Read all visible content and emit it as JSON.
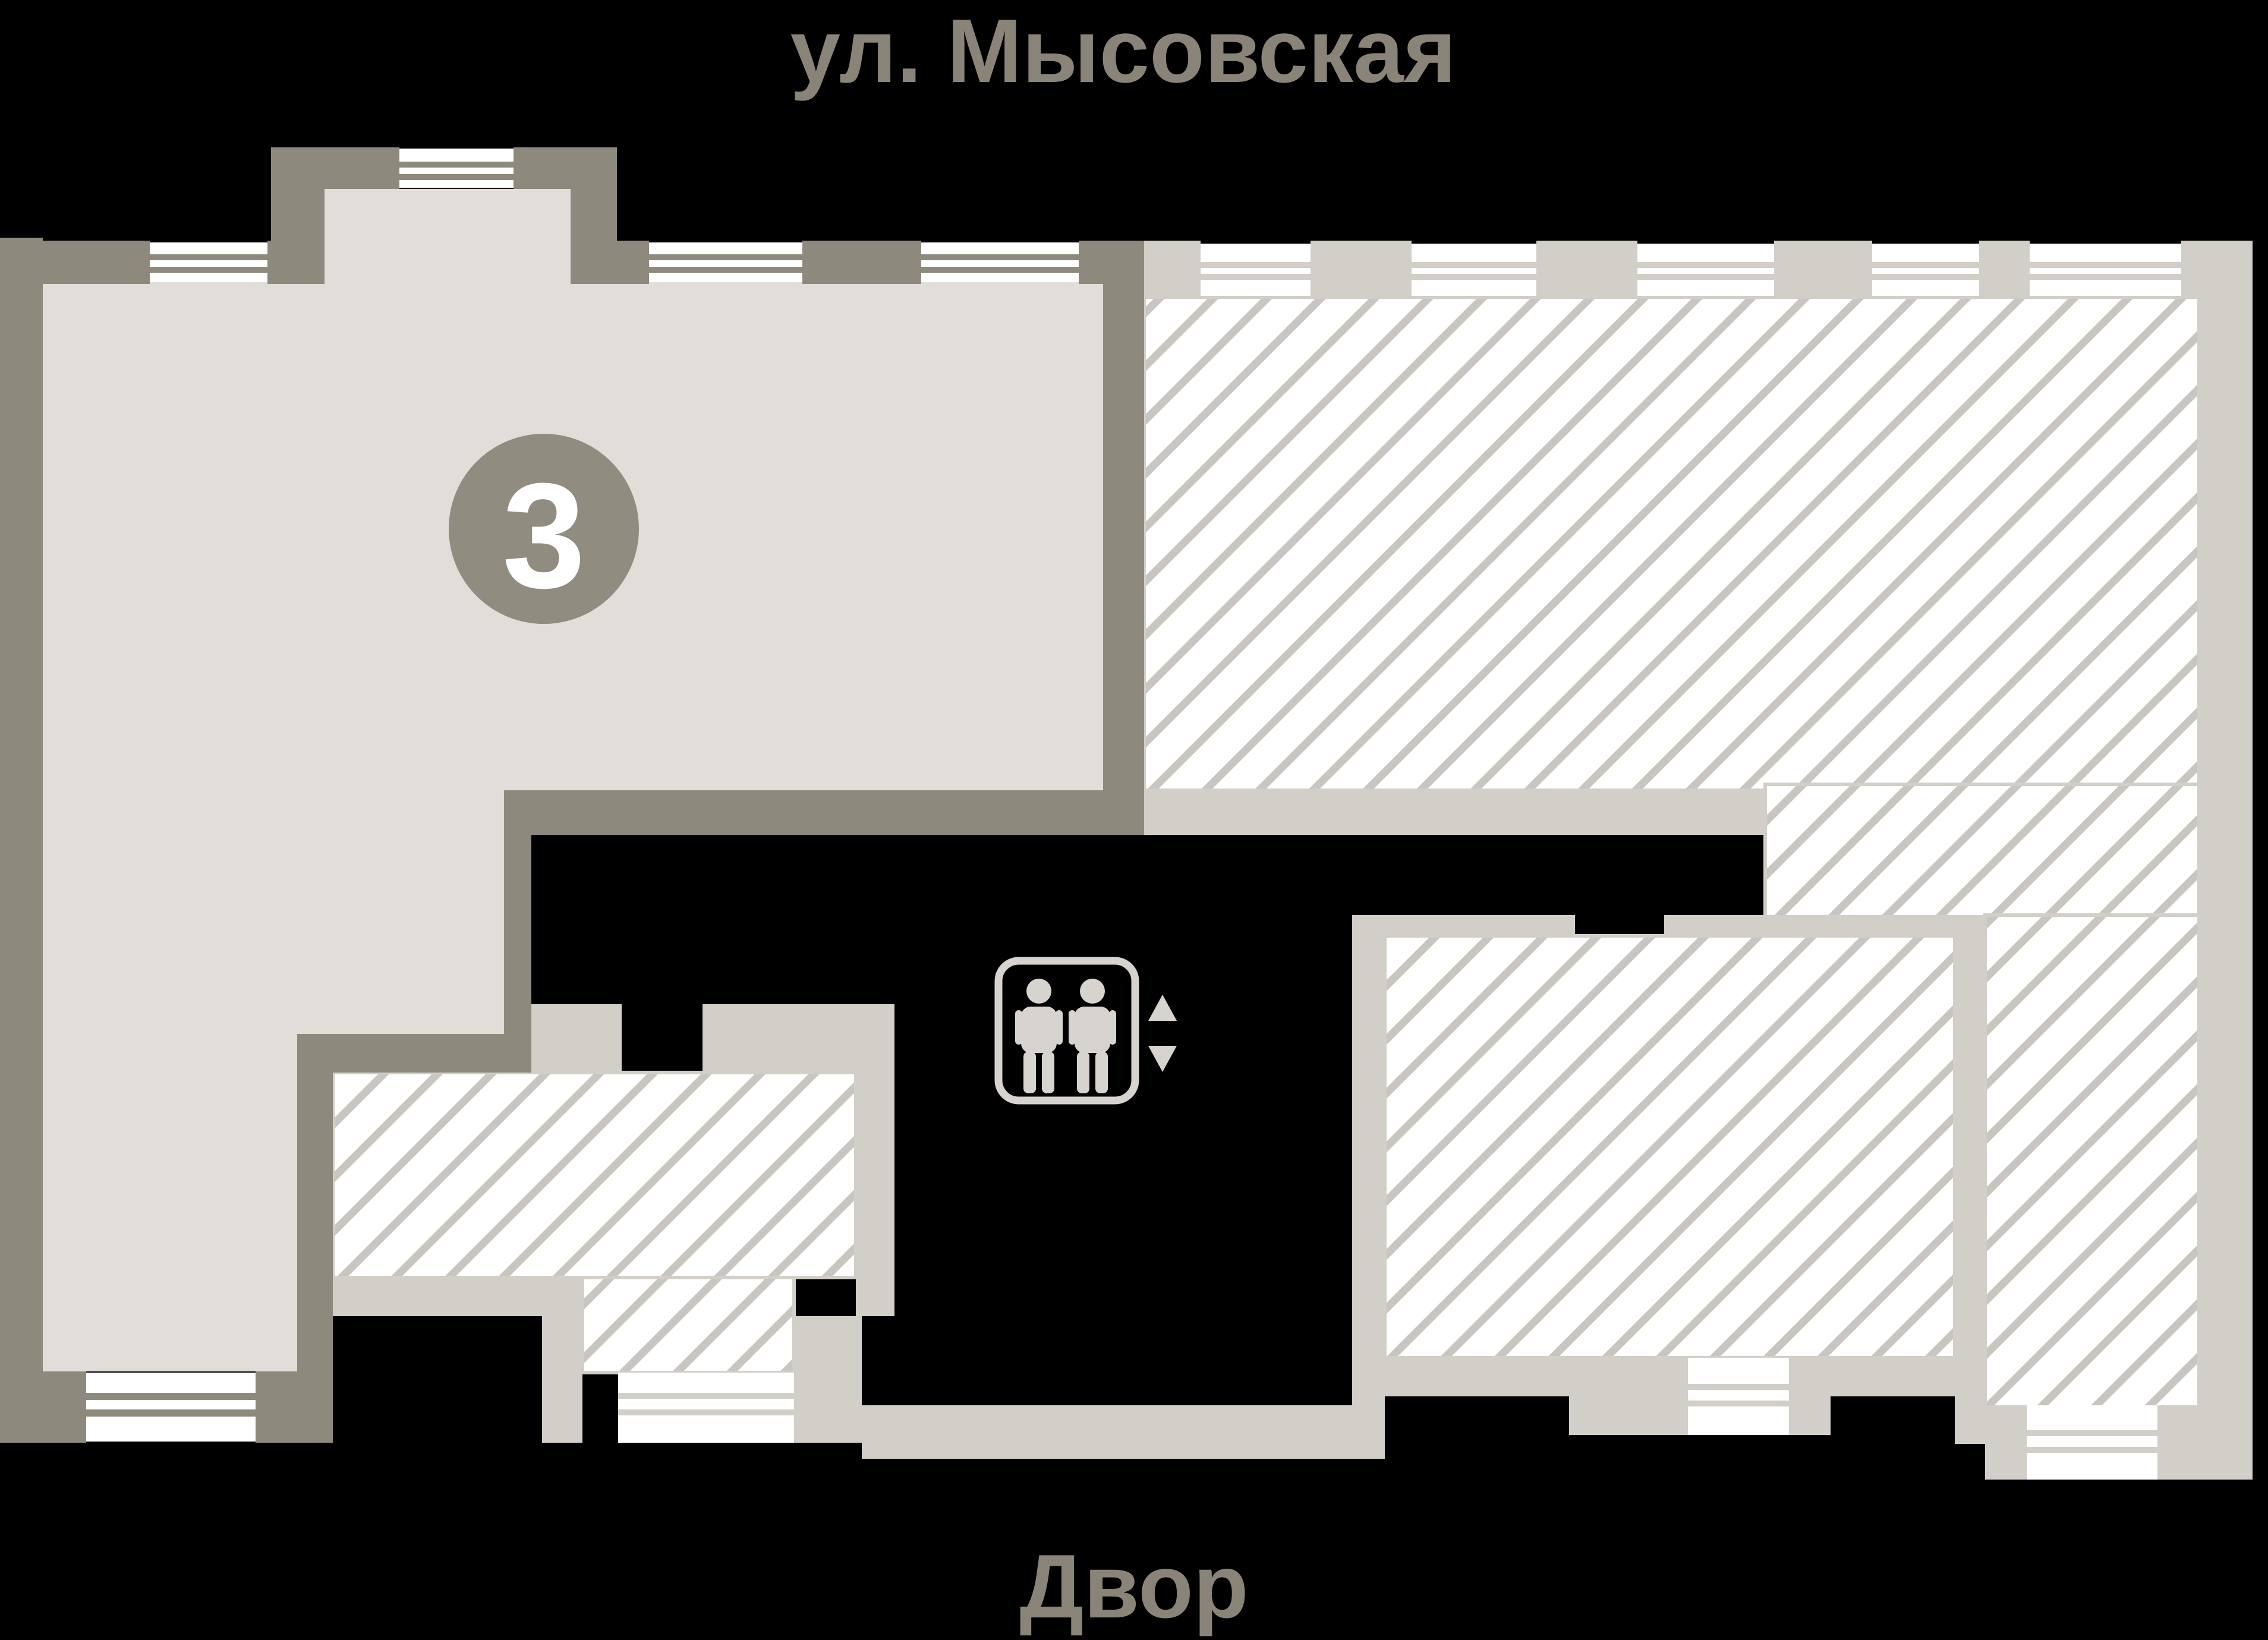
{
  "title": {
    "street": "ул. Мысовская",
    "courtyard": "Двор"
  },
  "apartment": {
    "number": "3"
  },
  "icons": {
    "elevator": "elevator-people-icon",
    "up": "triangle-up-icon",
    "down": "triangle-down-icon"
  },
  "colors": {
    "background": "#000000",
    "label_text": "#8a8478",
    "apartment_fill": "#e1ded9",
    "apartment_wall": "#8d897d",
    "neighbor_wall": "#d2cec8",
    "hatch_line": "#c9c5c0",
    "hatch_bg": "#ffffff",
    "window_line": "#8d897d",
    "badge_fill": "#918c80",
    "badge_text": "#ffffff",
    "icon_color": "#d7d3ce"
  }
}
